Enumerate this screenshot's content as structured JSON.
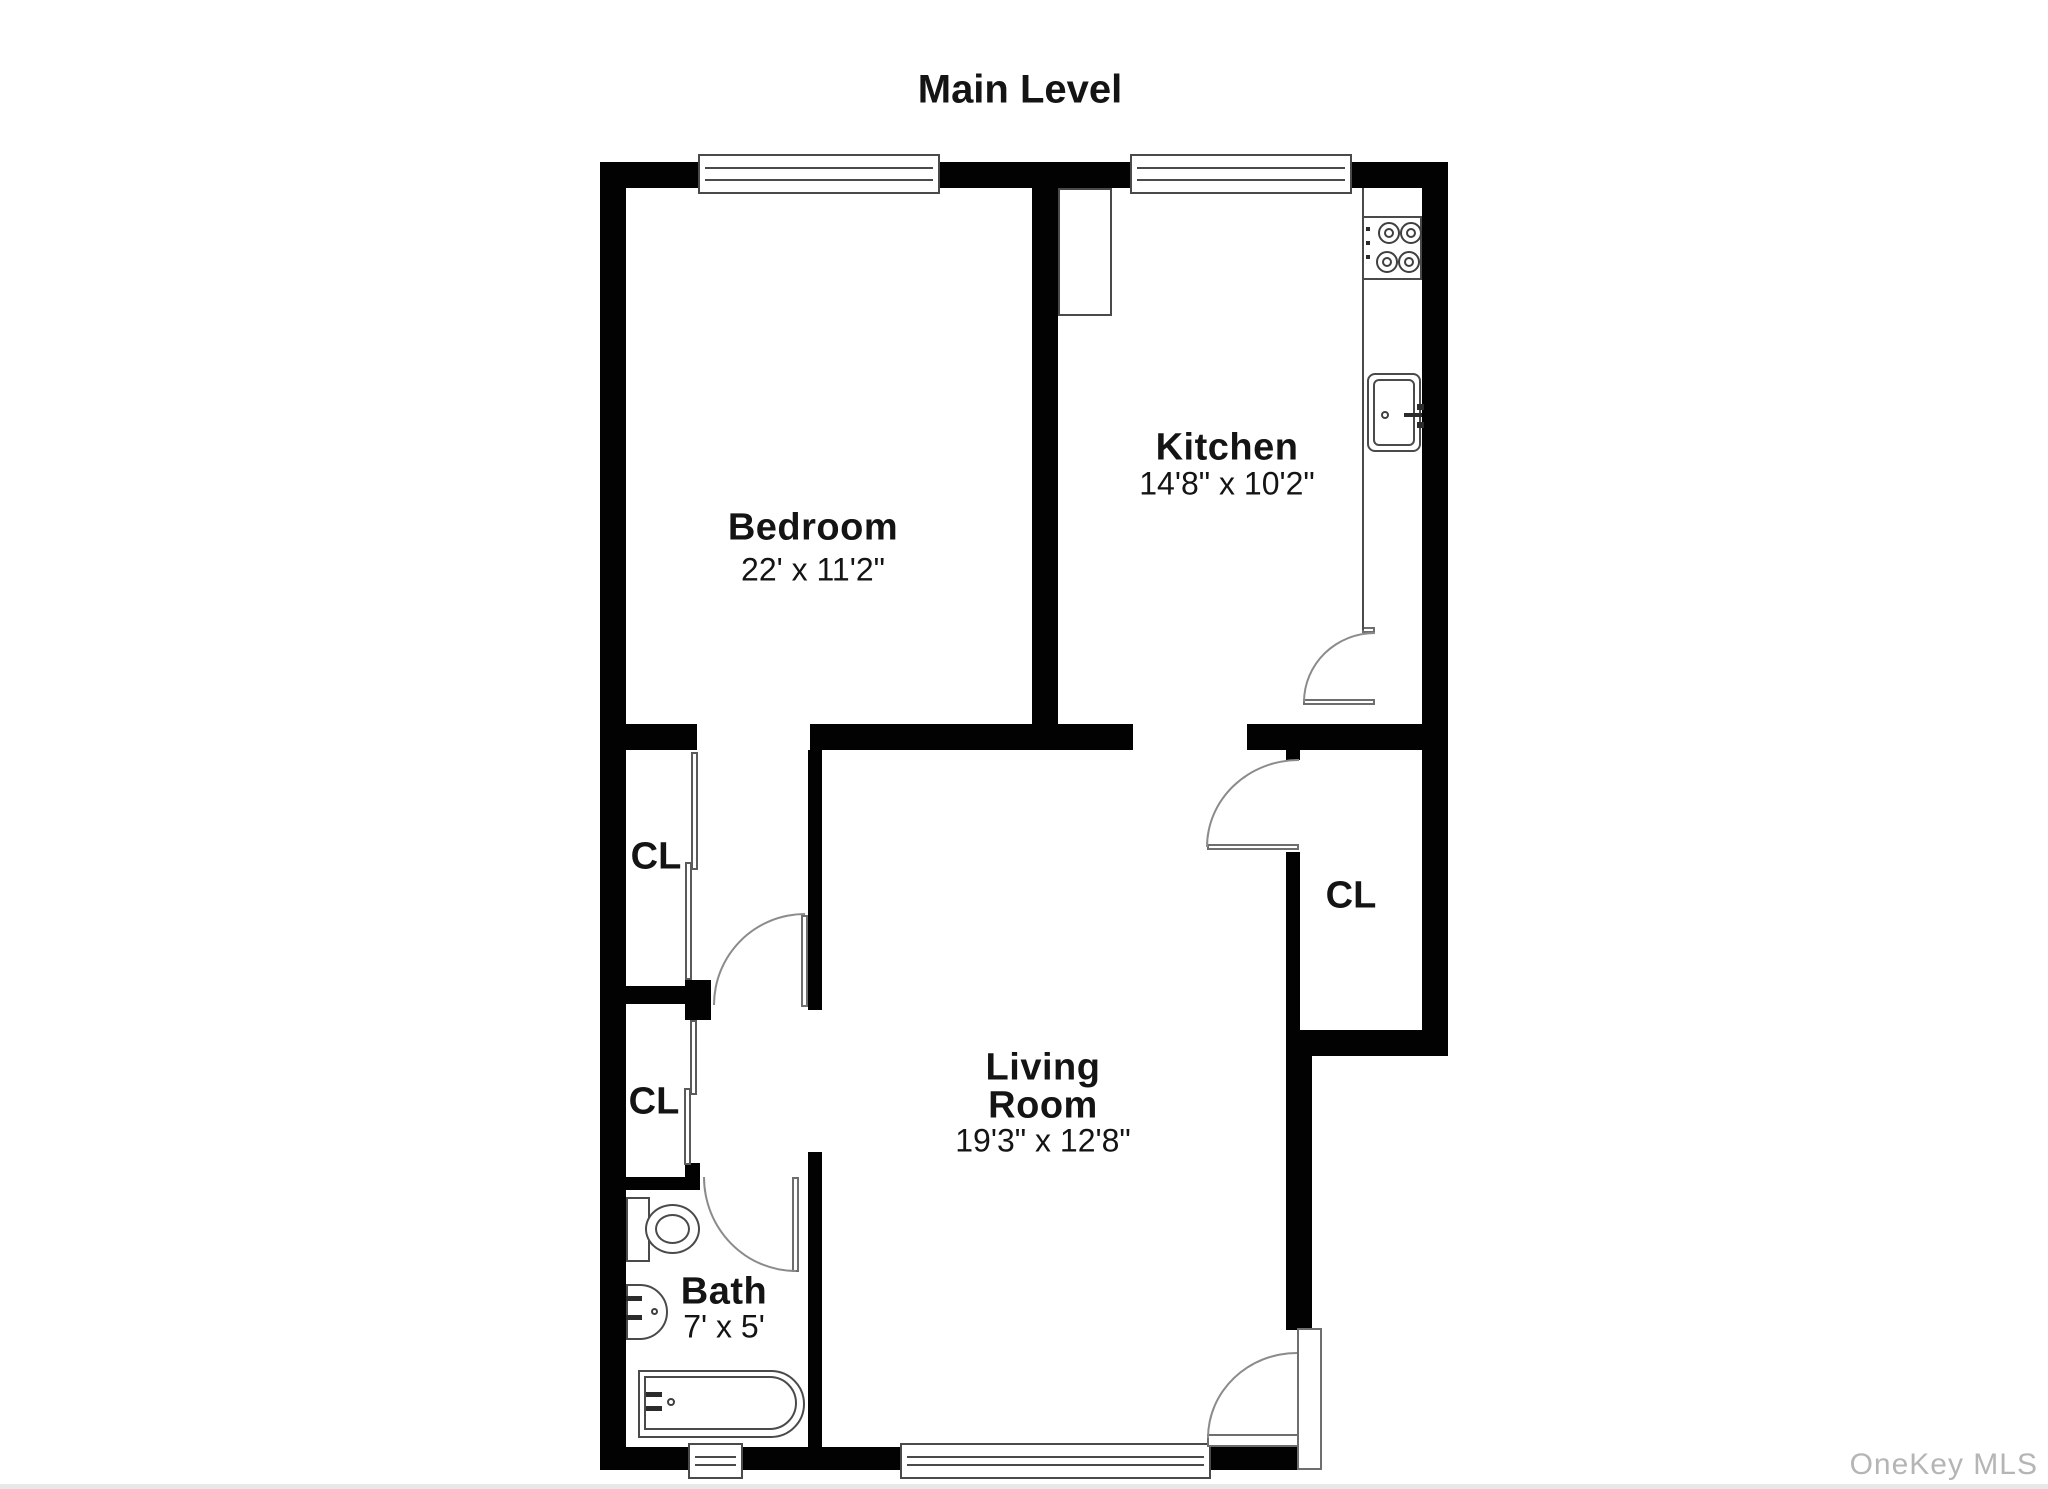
{
  "title": "Main Level",
  "rooms": {
    "bedroom": {
      "name": "Bedroom",
      "dims": "22' x 11'2\""
    },
    "kitchen": {
      "name": "Kitchen",
      "dims": "14'8\" x 10'2\""
    },
    "living": {
      "name_line1": "Living",
      "name_line2": "Room",
      "dims": "19'3\" x 12'8\""
    },
    "bath": {
      "name": "Bath",
      "dims": "7' x 5'"
    },
    "closet1": {
      "name": "CL"
    },
    "closet2": {
      "name": "CL"
    },
    "closet3": {
      "name": "CL"
    }
  },
  "watermark": "OneKey MLS",
  "colors": {
    "wall": "#020202",
    "line": "#4a4a4a",
    "arc": "#8b8b8b",
    "text": "#141414",
    "watermark": "#b5b5b5"
  }
}
